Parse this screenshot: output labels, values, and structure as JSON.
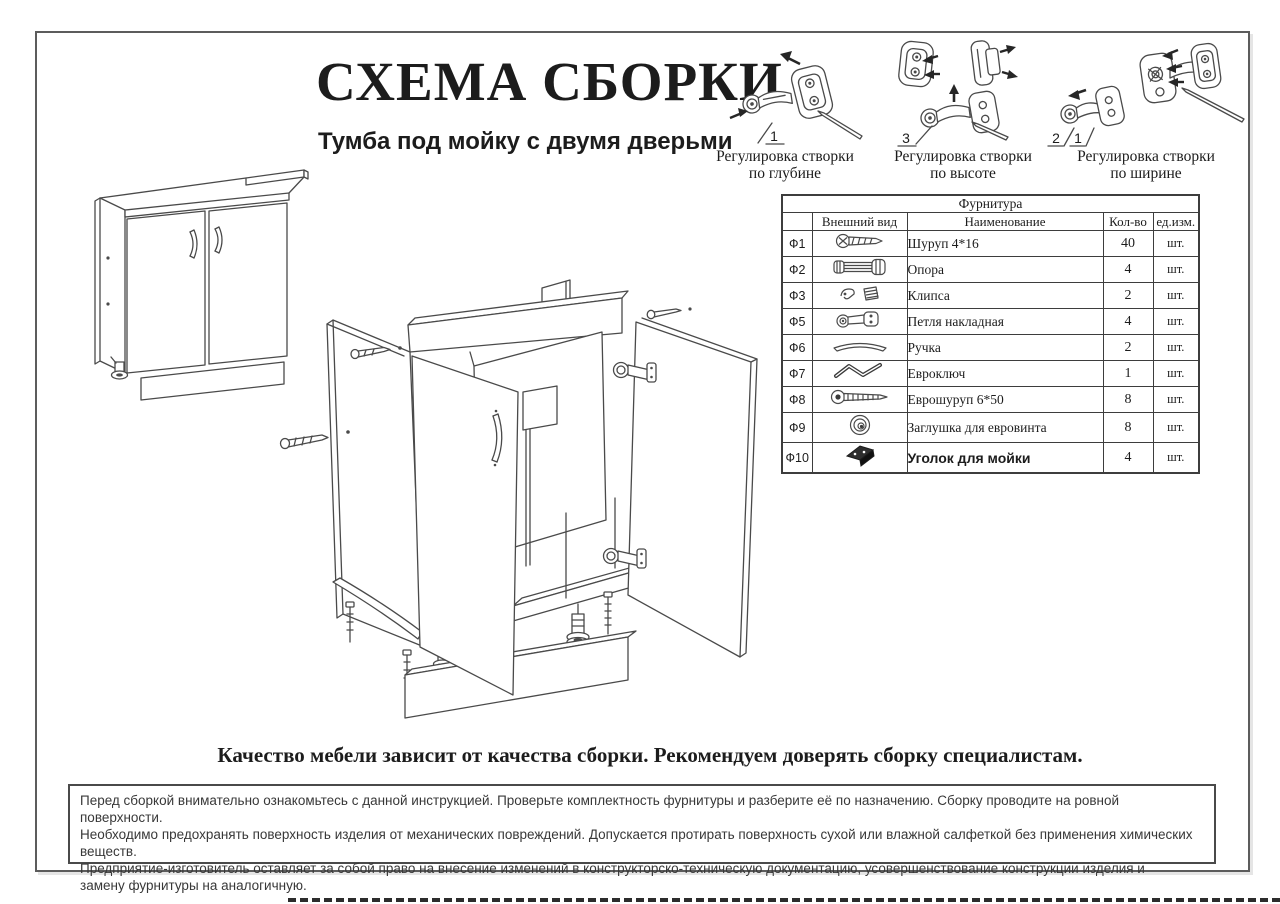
{
  "header": {
    "title": "СХЕМА СБОРКИ",
    "subtitle": "Тумба под мойку с двумя дверьми"
  },
  "adjustments": [
    {
      "caption_line1": "Регулировка створки",
      "caption_line2": "по глубине",
      "callouts": [
        "1"
      ]
    },
    {
      "caption_line1": "Регулировка створки",
      "caption_line2": "по высоте",
      "callouts": [
        "3"
      ]
    },
    {
      "caption_line1": "Регулировка створки",
      "caption_line2": "по ширине",
      "callouts": [
        "2",
        "1"
      ]
    }
  ],
  "hardware_table": {
    "title": "Фурнитура",
    "columns": {
      "appearance": "Внешний вид",
      "name": "Наименование",
      "qty": "Кол-во",
      "unit": "ед.изм."
    },
    "rows": [
      {
        "id": "Ф1",
        "icon": "screw-icon",
        "name": "Шуруп 4*16",
        "qty": "40",
        "unit": "шт."
      },
      {
        "id": "Ф2",
        "icon": "support-leg-icon",
        "name": "Опора",
        "qty": "4",
        "unit": "шт."
      },
      {
        "id": "Ф3",
        "icon": "clip-icon",
        "name": "Клипса",
        "qty": "2",
        "unit": "шт."
      },
      {
        "id": "Ф5",
        "icon": "overlay-hinge-icon",
        "name": "Петля накладная",
        "qty": "4",
        "unit": "шт."
      },
      {
        "id": "Ф6",
        "icon": "handle-icon",
        "name": "Ручка",
        "qty": "2",
        "unit": "шт."
      },
      {
        "id": "Ф7",
        "icon": "euro-key-icon",
        "name": "Евроключ",
        "qty": "1",
        "unit": "шт."
      },
      {
        "id": "Ф8",
        "icon": "euro-screw-icon",
        "name": "Еврошуруп 6*50",
        "qty": "8",
        "unit": "шт."
      },
      {
        "id": "Ф9",
        "icon": "screw-cap-icon",
        "name": "Заглушка для евровинта",
        "qty": "8",
        "unit": "шт."
      },
      {
        "id": "Ф10",
        "icon": "sink-bracket-icon",
        "name": "Уголок для мойки",
        "qty": "4",
        "unit": "шт.",
        "emphasis": true
      }
    ]
  },
  "slogan": "Качество мебели зависит от качества сборки. Рекомендуем доверять сборку специалистам.",
  "notice": {
    "lines": [
      "Перед сборкой внимательно ознакомьтесь с данной инструкцией. Проверьте комплектность фурнитуры и разберите её по назначению. Сборку проводите на ровной поверхности.",
      "Необходимо предохранять поверхность изделия от механических повреждений. Допускается протирать поверхность сухой или влажной салфеткой без применения химических веществ.",
      "Предприятие-изготовитель оставляет за собой право на внесение изменений в конструкторско-техническую документацию, усовершенствование конструкции изделия и",
      "замену фурнитуры на аналогичную."
    ]
  },
  "colors": {
    "ink": "#1c1c1c",
    "line_art": "#4a4a4a"
  }
}
